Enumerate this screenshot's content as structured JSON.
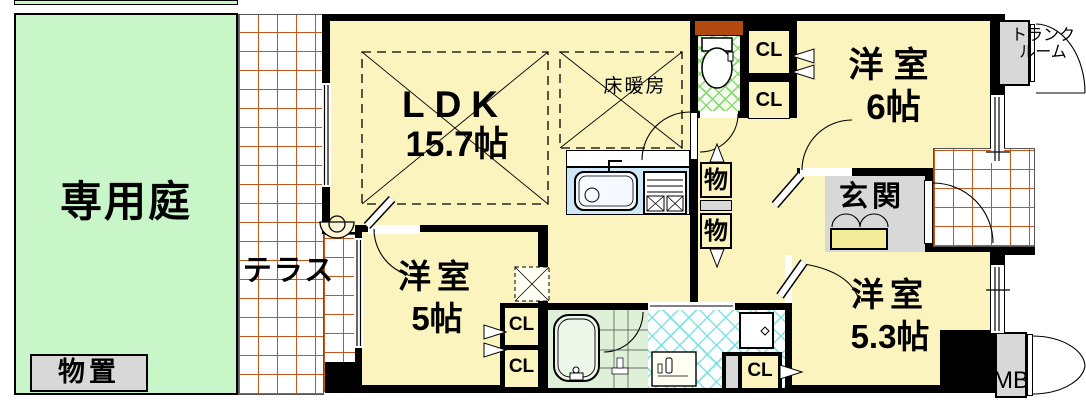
{
  "labels": {
    "garden": "専用庭",
    "shed": "物置",
    "terrace": "テラス",
    "ldk_name": "LDK",
    "ldk_size": "15.7帖",
    "floor_heating": "床暖房",
    "room6_name": "洋室",
    "room6_size": "6帖",
    "room5_name": "洋室",
    "room5_size": "5帖",
    "room53_name": "洋室",
    "room53_size": "5.3帖",
    "entrance": "玄関",
    "trunk_line1": "トランク",
    "trunk_line2": "ルーム",
    "closet": "CL",
    "storage": "物",
    "meter_box": "MB"
  },
  "colors": {
    "wall": "#000000",
    "room_yellow": "#FCF4BE",
    "garden_green": "#C9F6C9",
    "fixture_gray": "#D8D8D8",
    "terrace_grid": "#C1571C",
    "kitchen_blue": "#CFE8F7",
    "bath_green": "#DFF0D8",
    "toilet_hatch": "#86D96E",
    "wash_hatch": "#7CE0E0",
    "toilet_shelf": "#B24A10"
  }
}
